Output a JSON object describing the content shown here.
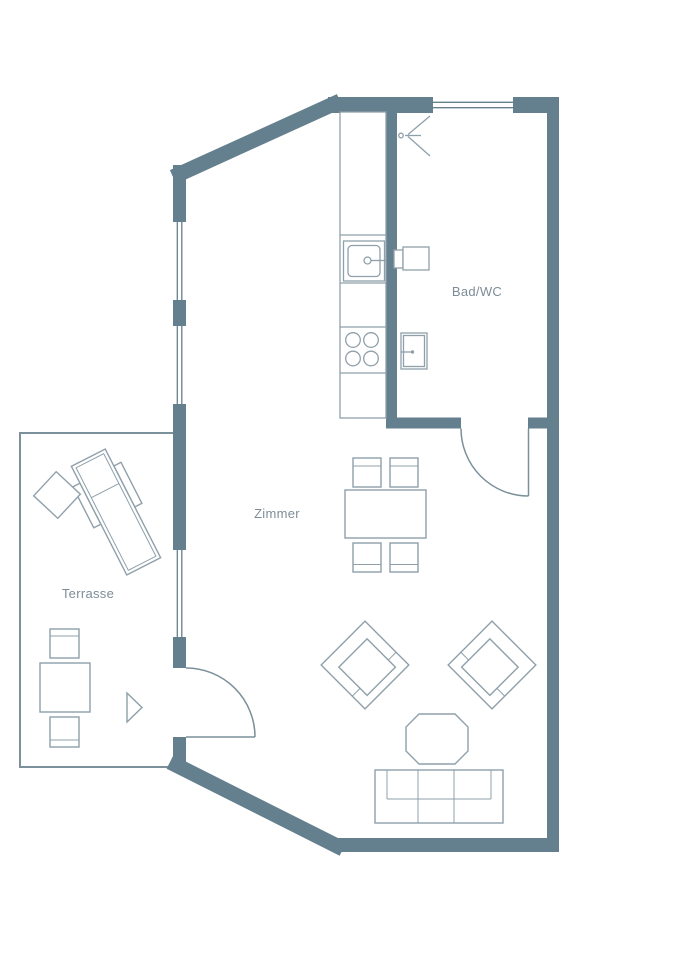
{
  "plan": {
    "type": "floor-plan",
    "rooms": {
      "zimmer": {
        "label": "Zimmer"
      },
      "bad_wc": {
        "label": "Bad/WC"
      },
      "terrasse": {
        "label": "Terrasse"
      }
    }
  },
  "colors": {
    "wall": "#647F8D",
    "furniture_line": "#8FA0AA",
    "terrace_line": "#7C909B",
    "label_text": "#7D8D98",
    "background": "#FFFFFF"
  }
}
